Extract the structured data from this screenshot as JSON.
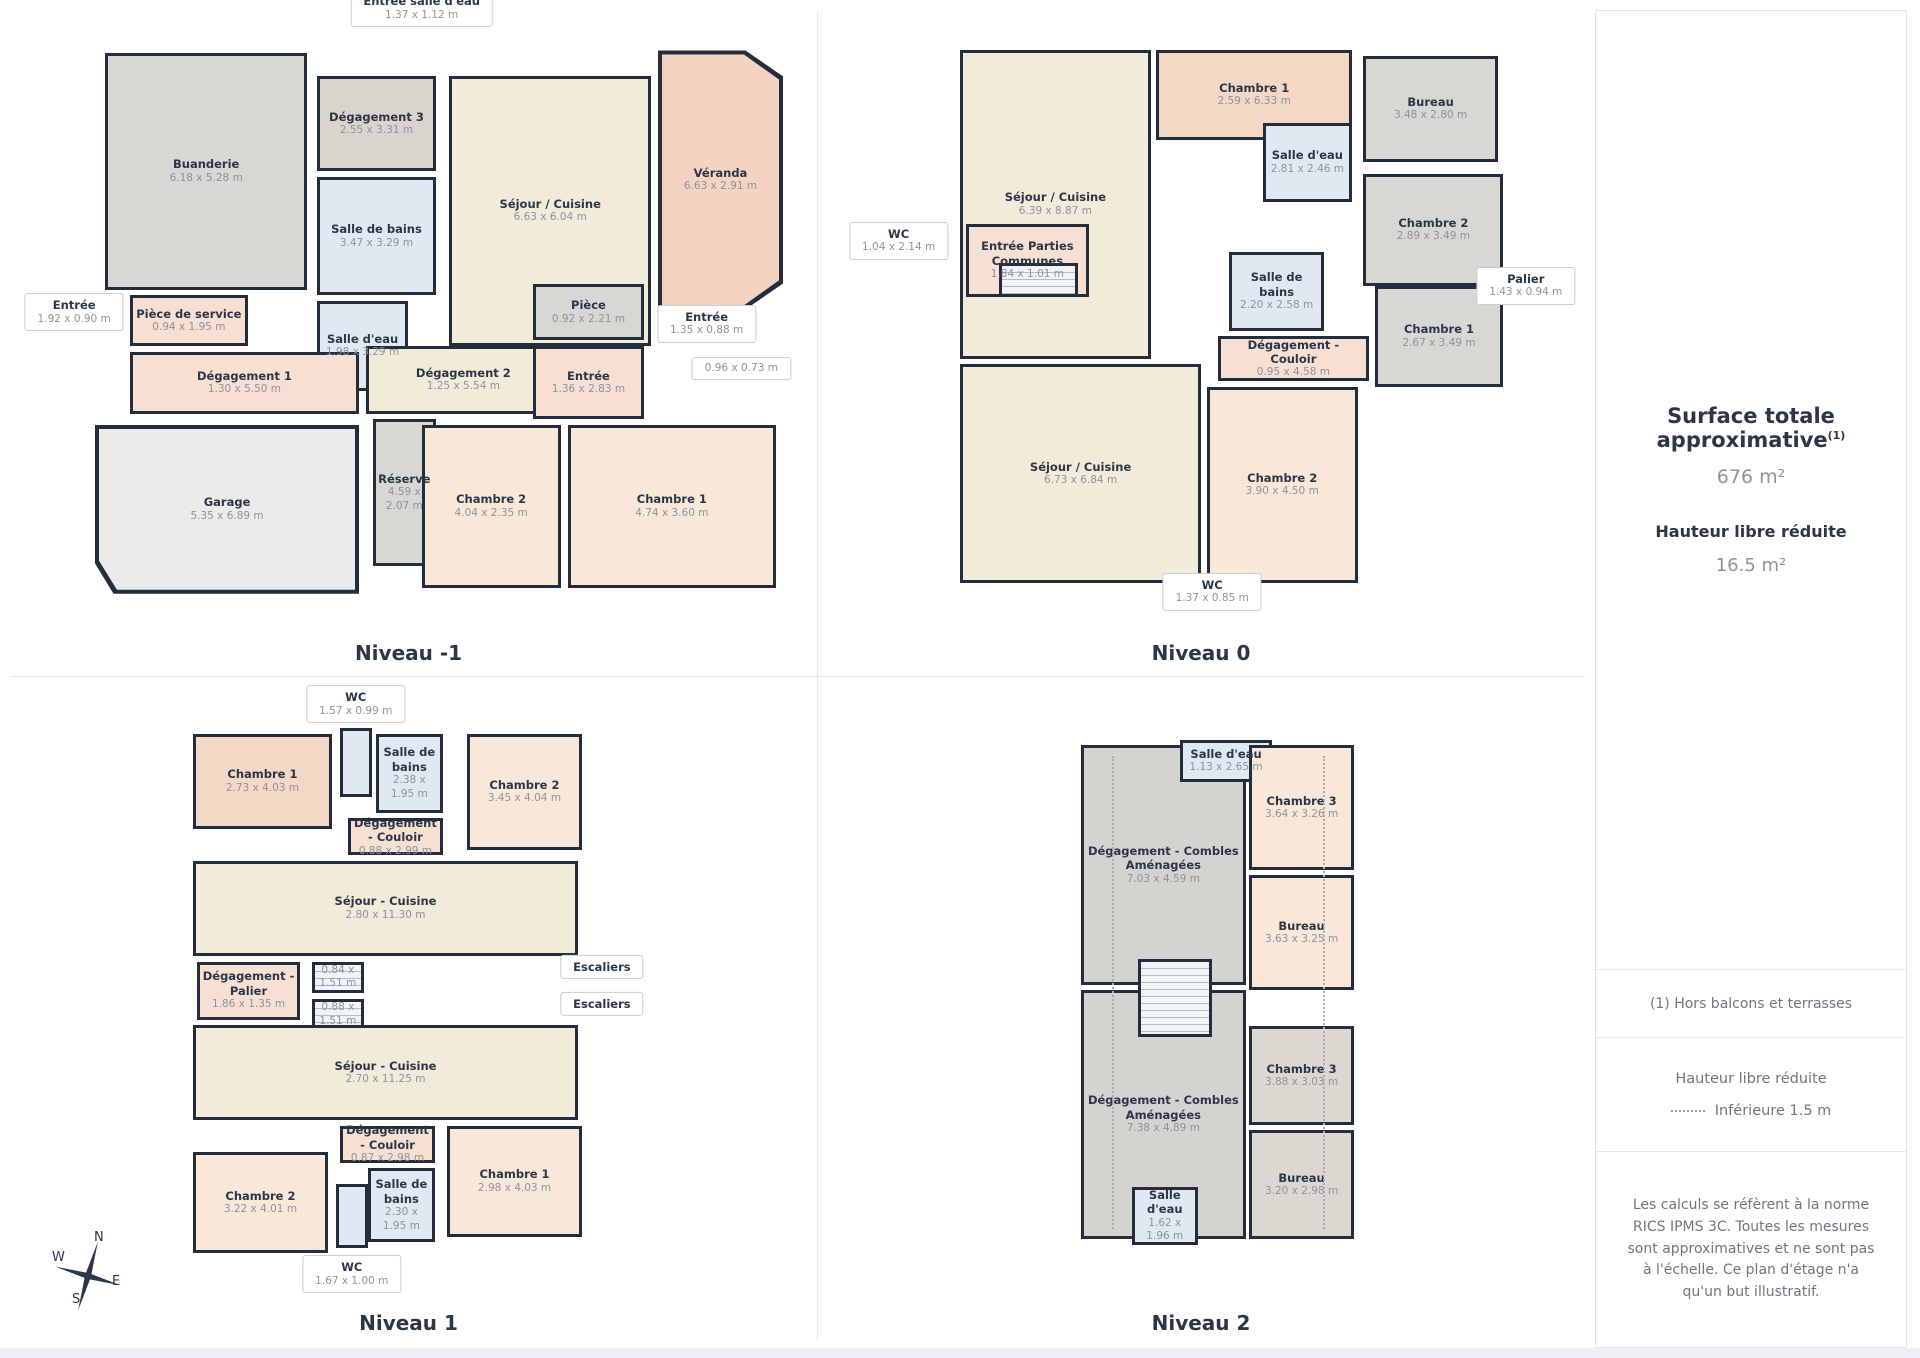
{
  "palette": {
    "wall": "#232d3d",
    "cream": "#f1ebd9",
    "salmon": "#f4d7c5",
    "peach": "#f9e7d7",
    "salmonlight": "#f7dfd1",
    "veranda": "#f3d3c1",
    "gray": "#d7d7d4",
    "warmgray": "#d9d4cc",
    "taupe": "#dcd8d1",
    "graybig": "#d3d3d0",
    "blue": "#e2e8f1",
    "garage": "#ebebe9"
  },
  "compass": {
    "n": "N",
    "e": "E",
    "s": "S",
    "w": "W"
  },
  "sidebar": {
    "title": "Surface totale approximative",
    "title_sup": "(1)",
    "total_value": "676 m²",
    "height_label": "Hauteur libre réduite",
    "height_value": "16.5 m²",
    "note": "(1) Hors balcons et terrasses",
    "legend_title": "Hauteur libre réduite",
    "legend_value": "Inférieure 1.5 m",
    "disclaimer": "Les calculs se réfèrent à la norme RICS IPMS 3C. Toutes les mesures sont approximatives et ne sont pas à l'échelle. Ce plan d'étage n'a qu'un but illustratif."
  },
  "levels": [
    {
      "title": "Niveau -1",
      "rooms": [
        {
          "name": "Buanderie",
          "dims": "6.18 x 5.28 m",
          "color": "gray",
          "rect": [
            1.5,
            2,
            29,
            42
          ]
        },
        {
          "name": "Dégagement 3",
          "dims": "2.55 x 3.31 m",
          "color": "warmgray",
          "rect": [
            32,
            6,
            17,
            17
          ]
        },
        {
          "name": "Salle de bains",
          "dims": "3.47 x 3.29 m",
          "color": "blue",
          "rect": [
            32,
            24,
            17,
            21
          ]
        },
        {
          "name": "Séjour / Cuisine",
          "dims": "6.63 x 6.04 m",
          "color": "cream",
          "rect": [
            51,
            6,
            29,
            48
          ]
        },
        {
          "name": "Véranda",
          "dims": "6.63 x 2.91 m",
          "color": "veranda",
          "rect": [
            81,
            1.5,
            18,
            46
          ],
          "clip": "veranda"
        },
        {
          "name": "Pièce de service",
          "dims": "0.94 x 1.95 m",
          "color": "salmonlight",
          "rect": [
            5,
            45,
            17,
            9
          ]
        },
        {
          "name": "Salle d'eau",
          "dims": "1.98 x 3.29 m",
          "color": "blue",
          "rect": [
            32,
            46,
            13,
            16
          ]
        },
        {
          "name": "Dégagement 1",
          "dims": "1.30 x 5.50 m",
          "color": "salmonlight",
          "rect": [
            5,
            55,
            33,
            11
          ]
        },
        {
          "name": "Dégagement 2",
          "dims": "1.25 x 5.54 m",
          "color": "cream",
          "rect": [
            39,
            54,
            28,
            12
          ]
        },
        {
          "name": "Pièce",
          "dims": "0.92 x 2.21 m",
          "color": "gray",
          "rect": [
            63,
            43,
            16,
            10
          ]
        },
        {
          "name": "Entrée",
          "dims": "1.36 x 2.83 m",
          "color": "salmonlight",
          "rect": [
            63,
            54,
            16,
            13
          ]
        },
        {
          "name": "Garage",
          "dims": "5.35 x 6.89 m",
          "color": "garage",
          "rect": [
            0,
            68,
            38,
            30
          ],
          "clip": "garage"
        },
        {
          "name": "Réserve",
          "dims": "4.59 x 2.07 m",
          "color": "gray",
          "rect": [
            40,
            67,
            9,
            26
          ]
        },
        {
          "name": "Chambre 2",
          "dims": "4.04 x 2.35 m",
          "color": "peach",
          "rect": [
            47,
            68,
            20,
            29
          ]
        },
        {
          "name": "Chambre 1",
          "dims": "4.74 x 3.60 m",
          "color": "peach",
          "rect": [
            68,
            68,
            30,
            29
          ]
        }
      ],
      "callouts": [
        {
          "name": "Entrée salle d'eau",
          "dims": "1.37 x 1.12 m",
          "x": 47,
          "y": -6
        },
        {
          "name": "Entrée",
          "dims": "1.92 x 0.90 m",
          "x": -3,
          "y": 48
        },
        {
          "name": "Entrée",
          "dims": "1.35 x 0.88 m",
          "x": 88,
          "y": 50
        },
        {
          "dims": "0.96 x 0.73 m",
          "x": 93,
          "y": 58
        }
      ]
    },
    {
      "title": "Niveau 0",
      "rooms": [
        {
          "name": "Séjour / Cuisine",
          "dims": "6.39 x 8.87 m",
          "color": "cream",
          "rect": [
            2,
            2,
            34,
            55
          ]
        },
        {
          "name": "Chambre 1",
          "dims": "2.59 x 6.33 m",
          "color": "salmon",
          "rect": [
            37,
            2,
            35,
            16
          ]
        },
        {
          "name": "Bureau",
          "dims": "3.48 x 2.80 m",
          "color": "gray",
          "rect": [
            74,
            3,
            24,
            19
          ]
        },
        {
          "name": "Salle d'eau",
          "dims": "2.81 x 2.46 m",
          "color": "blue",
          "rect": [
            56,
            15,
            16,
            14
          ]
        },
        {
          "name": "Chambre 2",
          "dims": "2.89 x 3.49 m",
          "color": "gray",
          "rect": [
            74,
            24,
            25,
            20
          ]
        },
        {
          "name": "Entrée Parties Communes",
          "dims": "1.84 x 1.01 m",
          "color": "salmonlight",
          "rect": [
            3,
            33,
            22,
            13
          ]
        },
        {
          "stairs": true,
          "color": "gray",
          "rect": [
            9,
            40,
            14,
            6
          ]
        },
        {
          "name": "Salle de bains",
          "dims": "2.20 x 2.58 m",
          "color": "blue",
          "rect": [
            50,
            38,
            17,
            14
          ]
        },
        {
          "name": "Dégagement - Couloir",
          "dims": "0.95 x 4.58 m",
          "color": "salmonlight",
          "rect": [
            48,
            53,
            27,
            8
          ]
        },
        {
          "name": "Chambre 1",
          "dims": "2.67 x 3.49 m",
          "color": "gray",
          "rect": [
            76,
            44,
            23,
            18
          ]
        },
        {
          "name": "Séjour / Cuisine",
          "dims": "6.73 x 6.84 m",
          "color": "cream",
          "rect": [
            2,
            58,
            43,
            39
          ]
        },
        {
          "name": "Chambre 2",
          "dims": "3.90 x 4.50 m",
          "color": "peach",
          "rect": [
            46,
            62,
            27,
            35
          ]
        }
      ],
      "callouts": [
        {
          "name": "WC",
          "dims": "1.04 x 2.14 m",
          "x": -9,
          "y": 36
        },
        {
          "name": "Palier",
          "dims": "1.43 x 0.94 m",
          "x": 103,
          "y": 44
        },
        {
          "name": "WC",
          "dims": "1.37 x 0.85 m",
          "x": 47,
          "y": 98.5
        }
      ]
    },
    {
      "title": "Niveau 1",
      "rooms": [
        {
          "name": "Chambre 1",
          "dims": "2.73 x 4.03 m",
          "color": "salmon",
          "rect": [
            1,
            2,
            35,
            18
          ]
        },
        {
          "color": "blue",
          "rect": [
            38,
            1,
            8,
            13
          ]
        },
        {
          "name": "Salle de bains",
          "dims": "2.38 x 1.95 m",
          "color": "blue",
          "rect": [
            47,
            2,
            17,
            15
          ]
        },
        {
          "name": "Chambre 2",
          "dims": "3.45 x 4.04 m",
          "color": "peach",
          "rect": [
            70,
            2,
            29,
            22
          ]
        },
        {
          "name": "Dégagement - Couloir",
          "dims": "0.88 x 2.99 m",
          "color": "salmonlight",
          "rect": [
            40,
            18,
            24,
            7
          ]
        },
        {
          "name": "Séjour - Cuisine",
          "dims": "2.80 x 11.30 m",
          "color": "cream",
          "rect": [
            1,
            26,
            97,
            18
          ]
        },
        {
          "name": "Dégagement - Palier",
          "dims": "1.86 x 1.35 m",
          "color": "salmonlight",
          "rect": [
            2,
            45,
            26,
            11
          ]
        },
        {
          "stairs": true,
          "dims": "0.84 x 1.51 m",
          "color": "gray",
          "rect": [
            31,
            45,
            13,
            6
          ]
        },
        {
          "stairs": true,
          "dims": "0.88 x 1.51 m",
          "color": "gray",
          "rect": [
            31,
            52,
            13,
            6
          ]
        },
        {
          "name": "Séjour - Cuisine",
          "dims": "2.70 x 11.25 m",
          "color": "cream",
          "rect": [
            1,
            57,
            97,
            18
          ]
        },
        {
          "name": "Dégagement - Couloir",
          "dims": "0.87 x 2.98 m",
          "color": "salmonlight",
          "rect": [
            38,
            76,
            24,
            7
          ]
        },
        {
          "name": "Chambre 1",
          "dims": "2.98 x 4.03 m",
          "color": "peach",
          "rect": [
            65,
            76,
            34,
            21
          ]
        },
        {
          "name": "Chambre 2",
          "dims": "3.22 x 4.01 m",
          "color": "peach",
          "rect": [
            1,
            81,
            34,
            19
          ]
        },
        {
          "name": "Salle de bains",
          "dims": "2.30 x 1.95 m",
          "color": "blue",
          "rect": [
            45,
            84,
            17,
            14
          ]
        },
        {
          "color": "blue",
          "rect": [
            37,
            87,
            8,
            12
          ]
        }
      ],
      "callouts": [
        {
          "name": "WC",
          "dims": "1.57 x 0.99 m",
          "x": 42,
          "y": -3.5
        },
        {
          "name": "Escaliers",
          "x": 104,
          "y": 46
        },
        {
          "name": "Escaliers",
          "x": 104,
          "y": 53
        },
        {
          "name": "WC",
          "dims": "1.67 x 1.00 m",
          "x": 41,
          "y": 104
        }
      ]
    },
    {
      "title": "Niveau 2",
      "rooms": [
        {
          "name": "Dégagement - Combles Aménagées",
          "dims": "7.03 x 4.59 m",
          "color": "graybig",
          "rect": [
            2,
            2,
            58,
            46
          ]
        },
        {
          "name": "Salle d'eau",
          "dims": "1.13 x 2.65 m",
          "color": "blue",
          "rect": [
            37,
            1,
            32,
            8
          ]
        },
        {
          "name": "Chambre 3",
          "dims": "3.64 x 3.26 m",
          "color": "peach",
          "rect": [
            61,
            2,
            37,
            24
          ]
        },
        {
          "name": "Bureau",
          "dims": "3.63 x 3.25 m",
          "color": "peach",
          "rect": [
            61,
            27,
            37,
            22
          ]
        },
        {
          "name": "Dégagement - Combles Aménagées",
          "dims": "7.38 x 4.89 m",
          "color": "graybig",
          "rect": [
            2,
            49,
            58,
            48
          ]
        },
        {
          "name": "Chambre 3",
          "dims": "3.88 x 3.03 m",
          "color": "taupe",
          "rect": [
            61,
            56,
            37,
            19
          ]
        },
        {
          "name": "Bureau",
          "dims": "3.20 x 2.98 m",
          "color": "taupe",
          "rect": [
            61,
            76,
            37,
            21
          ]
        },
        {
          "name": "Salle d'eau",
          "dims": "1.62 x 1.96 m",
          "color": "blue",
          "rect": [
            20,
            87,
            23,
            11
          ]
        },
        {
          "stairs": true,
          "color": "gray",
          "rect": [
            22,
            43,
            26,
            15
          ]
        }
      ],
      "callouts": [],
      "dashes": [
        {
          "x": 13,
          "y1": 4,
          "y2": 95
        },
        {
          "x": 87,
          "y1": 4,
          "y2": 95
        }
      ]
    }
  ]
}
